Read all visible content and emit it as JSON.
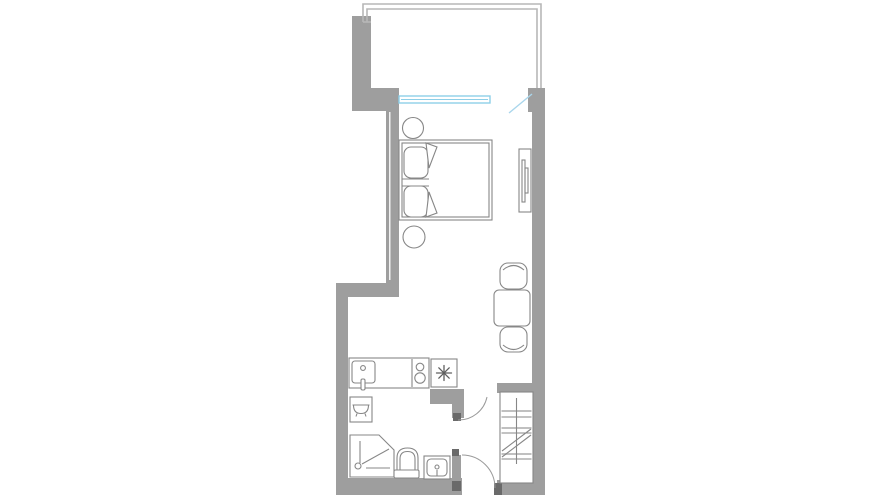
{
  "meta": {
    "width": 880,
    "height": 495,
    "title": "Studio apartment floor plan"
  },
  "palette": {
    "bg": "#ffffff",
    "wall": "#9e9e9e",
    "wall_dark": "#6a6a6a",
    "outline": "#878787",
    "outline_light": "#b7b7b7",
    "step_light": "#c0c0c0",
    "window_blue": "#8ecfe8",
    "door_blue": "#a9d6ec",
    "arc": "#9a9a9a",
    "asterisk": "#5f5f5f"
  },
  "rooms": [
    {
      "name": "balcony"
    },
    {
      "name": "sleeping-area"
    },
    {
      "name": "living-dining-area"
    },
    {
      "name": "kitchenette"
    },
    {
      "name": "bathroom"
    },
    {
      "name": "entry-hall"
    },
    {
      "name": "staircase"
    }
  ],
  "furniture": [
    {
      "name": "double-bed",
      "details": "two pillows, folded blanket corners"
    },
    {
      "name": "round-nightstand",
      "count": 2
    },
    {
      "name": "wall-mounted-tv"
    },
    {
      "name": "dining-table"
    },
    {
      "name": "dining-chair",
      "count": 2
    },
    {
      "name": "kitchen-counter-with-sink"
    },
    {
      "name": "cooktop-two-burners"
    },
    {
      "name": "refrigerator-snowflake-symbol"
    },
    {
      "name": "bathtub-cabinet"
    },
    {
      "name": "corner-shower-enclosure"
    },
    {
      "name": "toilet"
    },
    {
      "name": "washbasin"
    },
    {
      "name": "staircase-with-break-line"
    },
    {
      "name": "balcony-sliding-window"
    },
    {
      "name": "balcony-door-open-leaf"
    },
    {
      "name": "interior-door-swing",
      "count": 2
    }
  ]
}
